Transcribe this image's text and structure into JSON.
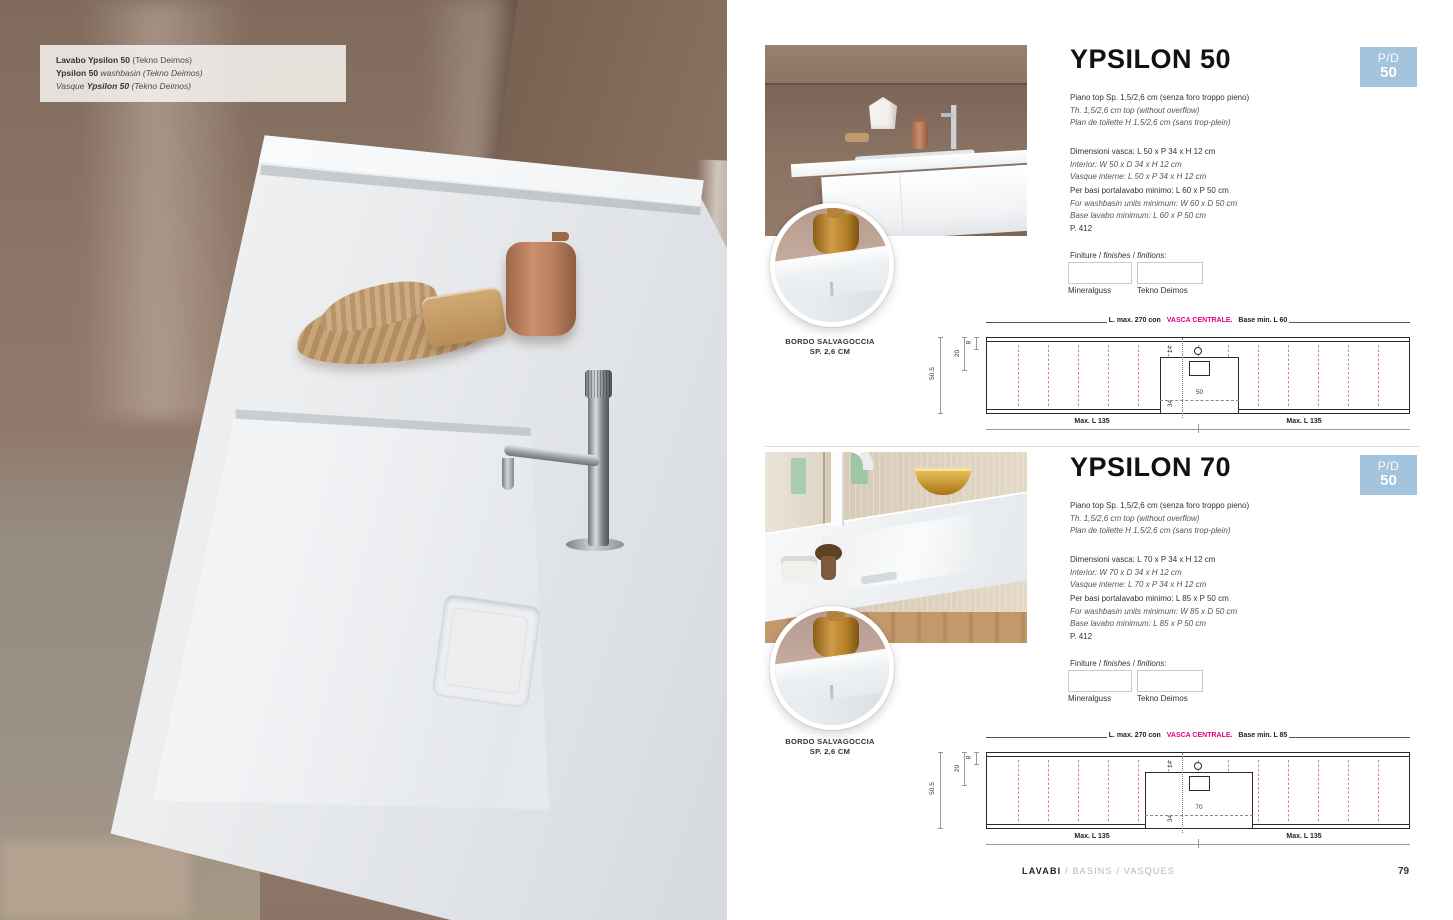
{
  "accent": {
    "badge_blue": "#a4c4dd",
    "magenta": "#e6007e",
    "pink_dash": "#d97fa5"
  },
  "caption": {
    "l1a": "Lavabo ",
    "l1b": "Ypsilon 50",
    "l1c": " (Tekno Deimos)",
    "l2a": "Ypsilon 50",
    "l2b": " washbasin (Tekno Deimos)",
    "l3a": "Vasque ",
    "l3b": "Ypsilon 50",
    "l3c": " (Tekno Deimos)"
  },
  "sections": [
    {
      "title": "YPSILON 50",
      "badge_top": "P/D",
      "badge_num": "50",
      "intro": [
        "Piano top Sp. 1,5/2,6 cm (senza foro troppo pieno)",
        "Th. 1,5/2,6 cm top (without overflow)",
        "Plan de toilette H 1,5/2,6 cm (sans trop-plein)"
      ],
      "vasca": [
        "Dimensioni vasca: L 50 x P 34 x H 12 cm",
        "Interior: W 50 x D 34 x H 12 cm",
        "Vasque interne: L 50 x P 34 x H 12 cm"
      ],
      "basi": [
        "Per basi portalavabo minimo: L 60 x P 50 cm",
        "For washbasin units minimum: W 60 x D 50 cm",
        "Base lavabo minimum: L 60 x P 50 cm"
      ],
      "page_ref": "P. 412",
      "fin": {
        "a": "Finiture / ",
        "b": "finishes",
        "c": " / ",
        "d": "finitions",
        "e": ":"
      },
      "swatches": [
        "Mineralguss",
        "Tekno Deimos"
      ],
      "inset": [
        "BORDO SALVAGOCCIA",
        "SP. 2,6 CM"
      ],
      "diagram": {
        "pre": "L. max. 270 con ",
        "accent": "VASCA CENTRALE.",
        "post": " Base min. L 60",
        "depth": "50.5",
        "d20": "20",
        "d8": "8",
        "d14": "14",
        "d34": "34",
        "width_label": "50",
        "max_left": "Max. L 135",
        "max_right": "Max. L 135"
      }
    },
    {
      "title": "YPSILON 70",
      "badge_top": "P/D",
      "badge_num": "50",
      "intro": [
        "Piano top Sp. 1,5/2,6 cm (senza foro troppo pieno)",
        "Th. 1,5/2,6 cm top (without overflow)",
        "Plan de toilette H 1,5/2,6 cm (sans trop-plein)"
      ],
      "vasca": [
        "Dimensioni vasca: L 70 x P 34 x H 12 cm",
        "Interior: W 70 x D 34 x H 12 cm",
        "Vasque interne: L 70 x P 34 x H 12 cm"
      ],
      "basi": [
        "Per basi portalavabo minimo: L 85 x P 50 cm",
        "For washbasin units minimum: W 85 x D 50 cm",
        "Base lavabo minimum: L 85 x P 50 cm"
      ],
      "page_ref": "P. 412",
      "fin": {
        "a": "Finiture / ",
        "b": "finishes",
        "c": " / ",
        "d": "finitions",
        "e": ":"
      },
      "swatches": [
        "Mineralguss",
        "Tekno Deimos"
      ],
      "inset": [
        "BORDO SALVAGOCCIA",
        "SP. 2,6 CM"
      ],
      "diagram": {
        "pre": "L. max. 270 con ",
        "accent": "VASCA CENTRALE.",
        "post": " Base min. L 85",
        "depth": "50.5",
        "d20": "20",
        "d8": "8",
        "d14": "14",
        "d34": "34",
        "width_label": "70",
        "max_left": "Max. L 135",
        "max_right": "Max. L 135"
      }
    }
  ],
  "footer": {
    "primary": "LAVABI",
    "secondary": " / BASINS / VASQUES",
    "page": "79"
  }
}
